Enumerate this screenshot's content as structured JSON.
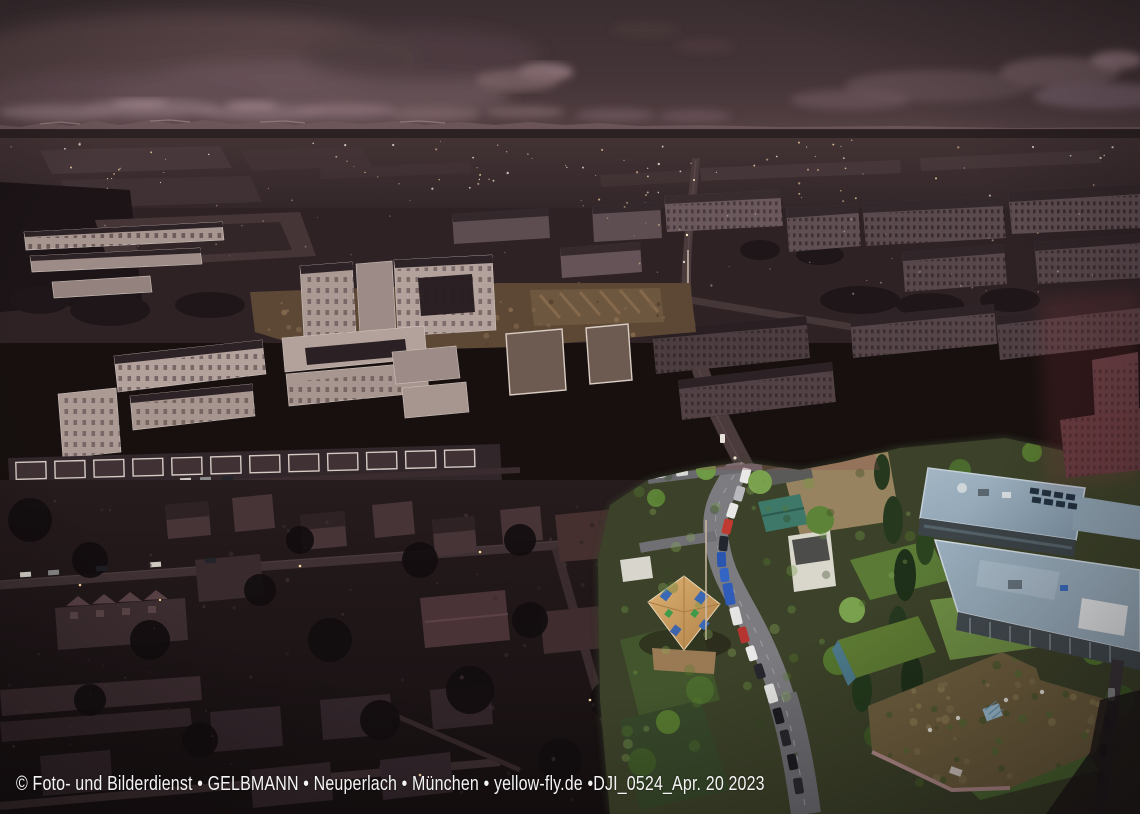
{
  "photo": {
    "caption": "© Foto- und Bilderdienst • GELBMANN • Neuperlach • München • yellow-fly.de •DJI_0524_Apr. 20 2023",
    "caption_parts": {
      "credit": "© Foto- und Bilderdienst",
      "author": "GELBMANN",
      "district": "Neuperlach",
      "city": "München",
      "website": "yellow-fly.de",
      "file_id": "DJI_0524",
      "date": "Apr. 20 2023"
    },
    "caption_color": "#f4f4f4"
  },
  "scene": {
    "type": "aerial-drone-photograph",
    "look": "dark desaturated sepia cityscape at dusk with one color-highlighted redevelopment area at lower right"
  },
  "colors": {
    "sky_top": "#3a2e31",
    "sky_horizon": "#584448",
    "far_land": "#392b2e",
    "suburb_dark": "#1d1416",
    "white_block_wall": "#b3a29c",
    "slab_wall": "#57474b",
    "highlight_grass": "#6f9045",
    "highlight_tree": "#6f9a45",
    "school_roof_blue": "#98acbb",
    "wood_roof": "#cf9f62",
    "tarp_blue": "#3a68b4",
    "car_red": "#c03a32",
    "car_blue": "#2b56b0",
    "city_light_warm": "#f6d7a4"
  }
}
